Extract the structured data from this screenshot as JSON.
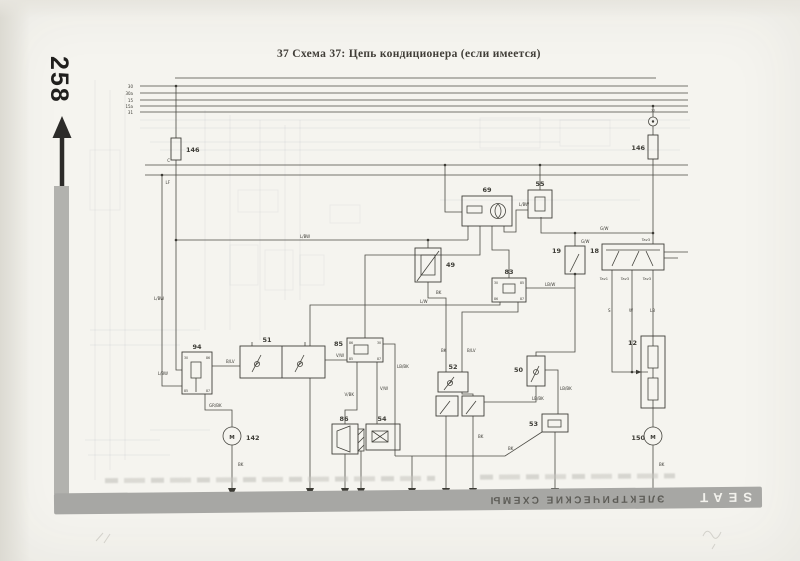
{
  "page": {
    "number": "258",
    "title": "37 Схема 37: Цепь кондиционера (если имеется)"
  },
  "footer": {
    "brand": "SEAT",
    "section": "ЭЛЕКТРИЧЕСКИЕ СХЕМЫ"
  },
  "colors": {
    "paper": "#f5f4ef",
    "bar_gray": "#a7a7a4",
    "line_dark": "#4b4a44"
  },
  "diagram": {
    "bus_labels": [
      {
        "t": "30",
        "x": 133,
        "y": 88,
        "a": "end"
      },
      {
        "t": "30a",
        "x": 133,
        "y": 95,
        "a": "end"
      },
      {
        "t": "15",
        "x": 133,
        "y": 102,
        "a": "end"
      },
      {
        "t": "15a",
        "x": 133,
        "y": 108,
        "a": "end"
      },
      {
        "t": "31",
        "x": 133,
        "y": 114,
        "a": "end"
      },
      {
        "t": "C",
        "x": 170,
        "y": 162,
        "a": "end"
      },
      {
        "t": "LF",
        "x": 170,
        "y": 184,
        "a": "end"
      }
    ],
    "component_numbers": [
      {
        "t": "146",
        "x": 186,
        "y": 152,
        "a": "start"
      },
      {
        "t": "146",
        "x": 645,
        "y": 150,
        "a": "end"
      },
      {
        "t": "69",
        "x": 487,
        "y": 192,
        "a": "middle"
      },
      {
        "t": "55",
        "x": 540,
        "y": 186,
        "a": "middle"
      },
      {
        "t": "49",
        "x": 446,
        "y": 267,
        "a": "start"
      },
      {
        "t": "83",
        "x": 509,
        "y": 274,
        "a": "middle"
      },
      {
        "t": "19",
        "x": 561,
        "y": 253,
        "a": "end"
      },
      {
        "t": "18",
        "x": 599,
        "y": 253,
        "a": "end"
      },
      {
        "t": "94",
        "x": 197,
        "y": 349,
        "a": "middle"
      },
      {
        "t": "51",
        "x": 267,
        "y": 342,
        "a": "middle"
      },
      {
        "t": "85",
        "x": 343,
        "y": 346,
        "a": "end"
      },
      {
        "t": "52",
        "x": 453,
        "y": 369,
        "a": "middle"
      },
      {
        "t": "50",
        "x": 523,
        "y": 372,
        "a": "end"
      },
      {
        "t": "12",
        "x": 637,
        "y": 345,
        "a": "end"
      },
      {
        "t": "86",
        "x": 344,
        "y": 421,
        "a": "middle"
      },
      {
        "t": "54",
        "x": 382,
        "y": 421,
        "a": "middle"
      },
      {
        "t": "53",
        "x": 538,
        "y": 426,
        "a": "end"
      },
      {
        "t": "142",
        "x": 246,
        "y": 440,
        "a": "start"
      },
      {
        "t": "150",
        "x": 645,
        "y": 440,
        "a": "end"
      }
    ],
    "wire_labels": [
      {
        "t": "L/BW",
        "x": 300,
        "y": 238
      },
      {
        "t": "L/BW",
        "x": 519,
        "y": 206
      },
      {
        "t": "G/W",
        "x": 600,
        "y": 230
      },
      {
        "t": "G/W",
        "x": 581,
        "y": 243
      },
      {
        "t": "L/W",
        "x": 420,
        "y": 303
      },
      {
        "t": "LB/W",
        "x": 545,
        "y": 286
      },
      {
        "t": "BK",
        "x": 436,
        "y": 294
      },
      {
        "t": "BK",
        "x": 441,
        "y": 352
      },
      {
        "t": "B/LV",
        "x": 467,
        "y": 352
      },
      {
        "t": "L/BW",
        "x": 154,
        "y": 300
      },
      {
        "t": "L/BW",
        "x": 168,
        "y": 375,
        "a": "end"
      },
      {
        "t": "B/LV",
        "x": 226,
        "y": 363
      },
      {
        "t": "GR/BK",
        "x": 209,
        "y": 407,
        "a": "start"
      },
      {
        "t": "V/W",
        "x": 336,
        "y": 357
      },
      {
        "t": "V/W",
        "x": 380,
        "y": 390,
        "a": "start"
      },
      {
        "t": "V/BK",
        "x": 354,
        "y": 396,
        "a": "end"
      },
      {
        "t": "LB/BK",
        "x": 397,
        "y": 368,
        "a": "start"
      },
      {
        "t": "LB/BK",
        "x": 532,
        "y": 400
      },
      {
        "t": "LB/BK",
        "x": 560,
        "y": 390,
        "a": "start"
      },
      {
        "t": "S",
        "x": 608,
        "y": 312
      },
      {
        "t": "W",
        "x": 629,
        "y": 312
      },
      {
        "t": "LB",
        "x": 650,
        "y": 312
      },
      {
        "t": "BK",
        "x": 238,
        "y": 466,
        "a": "start"
      },
      {
        "t": "BK",
        "x": 659,
        "y": 466,
        "a": "start"
      },
      {
        "t": "BK",
        "x": 478,
        "y": 438,
        "a": "start"
      },
      {
        "t": "BK",
        "x": 508,
        "y": 450
      }
    ],
    "connector_labels": [
      {
        "t": "Tav3",
        "x": 650,
        "y": 241,
        "a": "end"
      },
      {
        "t": "Tav1",
        "x": 608,
        "y": 280,
        "a": "end"
      },
      {
        "t": "Tav3",
        "x": 629,
        "y": 280,
        "a": "end"
      },
      {
        "t": "Tav3",
        "x": 651,
        "y": 280,
        "a": "end"
      }
    ],
    "terminal_labels": [
      {
        "t": "77",
        "x": 653,
        "y": 112,
        "a": "middle"
      },
      {
        "t": "30",
        "x": 184,
        "y": 359
      },
      {
        "t": "86",
        "x": 210,
        "y": 359,
        "a": "end"
      },
      {
        "t": "85",
        "x": 184,
        "y": 392
      },
      {
        "t": "87",
        "x": 210,
        "y": 392,
        "a": "end"
      },
      {
        "t": "86",
        "x": 349,
        "y": 344
      },
      {
        "t": "30",
        "x": 381,
        "y": 344,
        "a": "end"
      },
      {
        "t": "85",
        "x": 349,
        "y": 360
      },
      {
        "t": "87",
        "x": 381,
        "y": 360,
        "a": "end"
      },
      {
        "t": "30",
        "x": 494,
        "y": 284
      },
      {
        "t": "85",
        "x": 524,
        "y": 284,
        "a": "end"
      },
      {
        "t": "86",
        "x": 494,
        "y": 300
      },
      {
        "t": "87",
        "x": 524,
        "y": 300,
        "a": "end"
      }
    ],
    "motor_letters": [
      {
        "t": "M",
        "x": 232,
        "y": 439,
        "a": "middle"
      },
      {
        "t": "M",
        "x": 653,
        "y": 439,
        "a": "middle"
      }
    ]
  }
}
